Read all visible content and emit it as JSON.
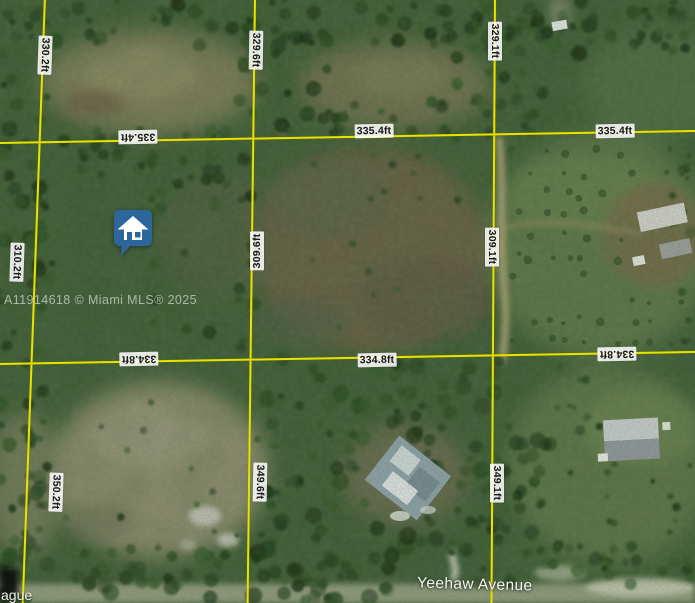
{
  "watermark": "A11914618 © Miami MLS® 2025",
  "streets": {
    "yeehaw": "Yeehaw Avenue",
    "partial": "ague"
  },
  "measurements": {
    "v_top_left": "330.2ft",
    "v_top_center": "329.6ft",
    "v_top_right": "329.1ft",
    "h1_left": "335.4ft",
    "h1_center": "335.4ft",
    "h1_right": "335.4ft",
    "v_mid_left": "310.2ft",
    "v_mid_center": "309.6ft",
    "v_mid_right": "309.1ft",
    "h2_left": "334.8ft",
    "h2_center": "334.8ft",
    "h2_right": "334.8ft",
    "v_bot_left": "350.2ft",
    "v_bot_center": "349.6ft",
    "v_bot_right": "349.1ft"
  },
  "icons": {
    "marker": "home-icon"
  },
  "colors": {
    "survey_line": "#e8e203",
    "marker_pin": "#2b679c",
    "label_background": "#ffffff",
    "label_text": "#161616"
  }
}
